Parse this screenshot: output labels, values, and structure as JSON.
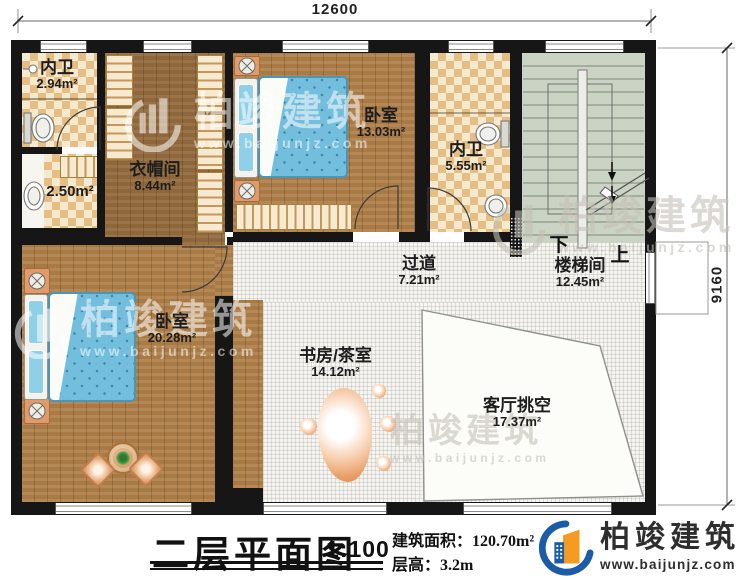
{
  "dimensions": {
    "top": "12600",
    "right": "9160"
  },
  "rooms": {
    "bath_top": {
      "name": "内卫",
      "area": "2.94m²"
    },
    "bath_small": {
      "area": "2.50m²"
    },
    "closet": {
      "name": "衣帽间",
      "area": "8.44m²"
    },
    "bedroom_top": {
      "name": "卧室",
      "area": "13.03m²"
    },
    "bath_right": {
      "name": "内卫",
      "area": "5.55m²"
    },
    "stairwell": {
      "name": "楼梯间",
      "area": "12.45m²"
    },
    "corridor": {
      "name": "过道",
      "area": "7.21m²"
    },
    "bedroom_main": {
      "name": "卧室",
      "area": "20.28m²"
    },
    "study": {
      "name": "书房/茶室",
      "area": "14.12m²"
    },
    "living_void": {
      "name": "客厅挑空",
      "area": "17.37m²"
    }
  },
  "stairs": {
    "down": "下",
    "up": "上"
  },
  "title": {
    "name": "二层平面图",
    "scale": "1:100",
    "build_area_label": "建筑面积：",
    "build_area": "120.70m²",
    "floor_height_label": "层高：",
    "floor_height": "3.2m"
  },
  "logo": {
    "name": "柏竣建筑",
    "url": "www.baijunjz.com"
  },
  "watermark": {
    "name": "柏竣建筑",
    "url": "www.baijunjz.com"
  }
}
